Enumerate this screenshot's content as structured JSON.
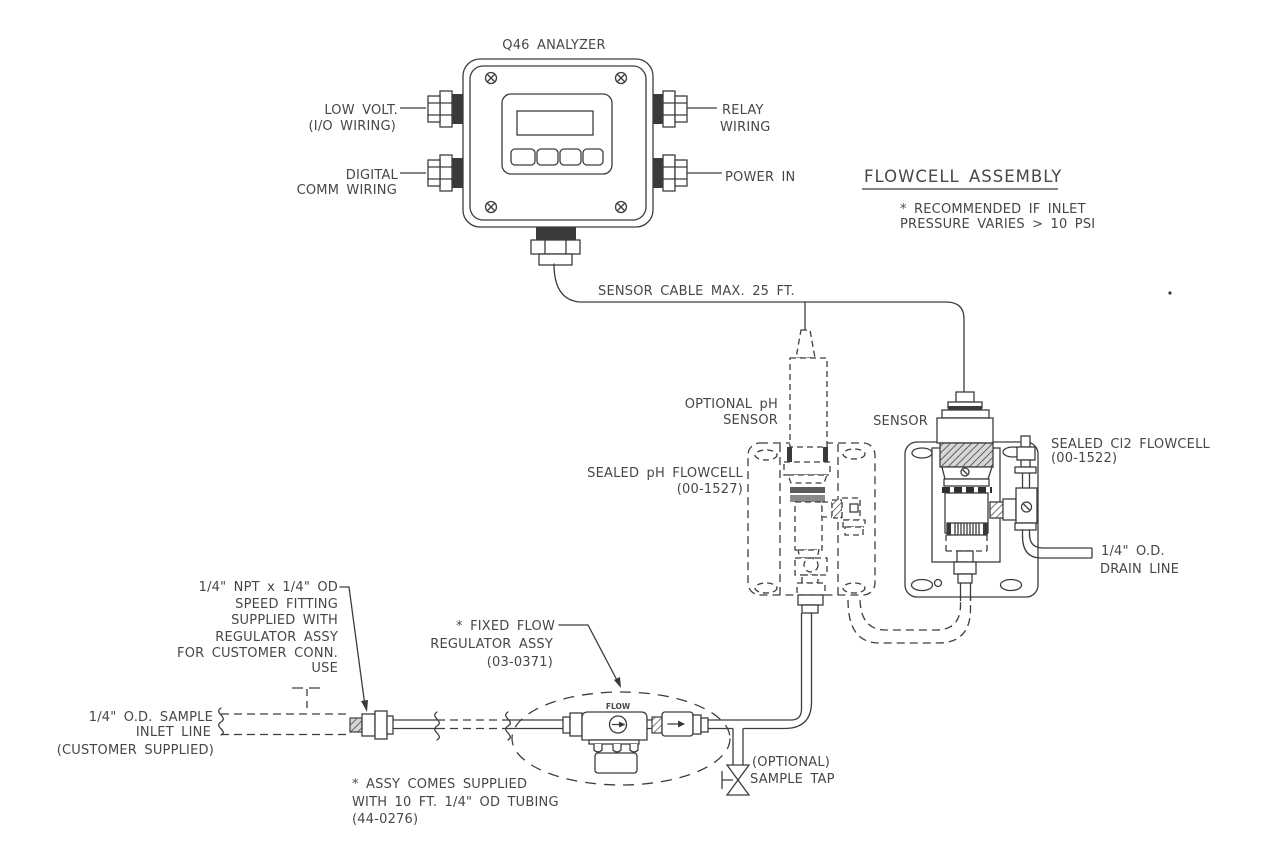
{
  "drawing": {
    "ink": "#3d3d3d",
    "paper": "#ffffff"
  },
  "analyzer": {
    "title": "Q46 ANALYZER",
    "labels": {
      "low_volt": [
        "LOW VOLT.",
        "(I/O WIRING)"
      ],
      "digital": [
        "DIGITAL",
        "COMM WIRING"
      ],
      "relay": [
        "RELAY",
        "WIRING"
      ],
      "power": "POWER IN"
    }
  },
  "flowcell_assembly": {
    "heading": "FLOWCELL ASSEMBLY",
    "note": [
      "* RECOMMENDED IF INLET",
      "PRESSURE VARIES > 10 PSI"
    ]
  },
  "cable": {
    "label": "SENSOR CABLE MAX. 25 FT."
  },
  "ph": {
    "sensor": [
      "OPTIONAL pH",
      "SENSOR"
    ],
    "flowcell": [
      "SEALED pH FLOWCELL",
      "(00-1527)"
    ]
  },
  "cl2": {
    "sensor": "SENSOR",
    "flowcell": [
      "SEALED Cl2 FLOWCELL",
      "(00-1522)"
    ],
    "drain": [
      "1/4\" O.D.",
      "DRAIN LINE"
    ]
  },
  "inlet": {
    "fitting_note": [
      "1/4\" NPT x 1/4\" OD",
      "SPEED FITTING",
      "SUPPLIED WITH",
      "REGULATOR ASSY",
      "FOR CUSTOMER CONN.",
      "USE"
    ],
    "line_label": [
      "1/4\" O.D. SAMPLE",
      "INLET LINE",
      "(CUSTOMER SUPPLIED)"
    ]
  },
  "regulator": {
    "label": [
      "* FIXED FLOW",
      "REGULATOR ASSY",
      "(03-0371)"
    ],
    "flow_marking": "FLOW",
    "tubing_note": [
      "* ASSY COMES SUPPLIED",
      "WITH 10 FT. 1/4\" OD TUBING",
      "(44-0276)"
    ]
  },
  "sample_tap": {
    "label": [
      "(OPTIONAL)",
      "SAMPLE TAP"
    ]
  }
}
